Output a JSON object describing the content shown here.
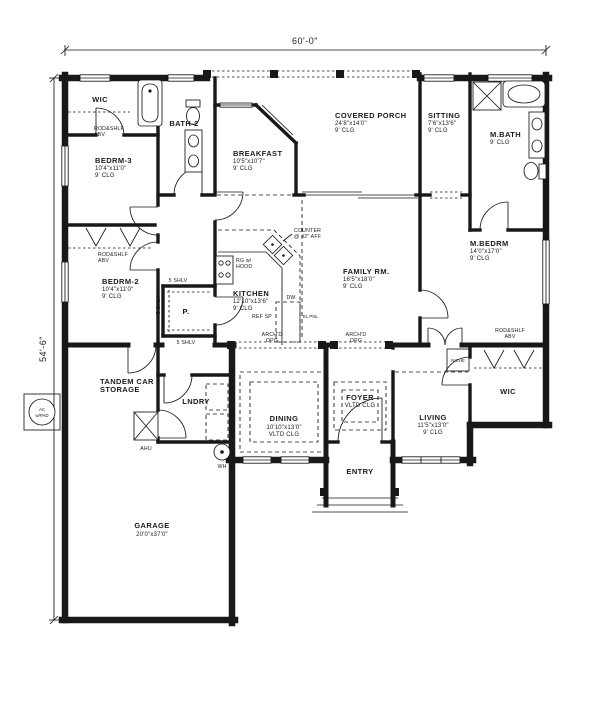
{
  "dimensions": {
    "top": "60'-0\"",
    "left": "54'-6\""
  },
  "rooms": {
    "wic1": {
      "name": "WIC"
    },
    "bedrm3": {
      "name": "BEDRM-3",
      "size": "10'4\"x11'0\"",
      "clg": "9' CLG"
    },
    "bath2": {
      "name": "BATH-2"
    },
    "bedrm2": {
      "name": "BEDRM-2",
      "size": "10'4\"x11'0\"",
      "clg": "9' CLG"
    },
    "breakfast": {
      "name": "BREAKFAST",
      "size": "10'5\"x10'7\"",
      "clg": "9' CLG"
    },
    "porch": {
      "name": "COVERED PORCH",
      "size": "24'8\"x14'0\"",
      "clg": "9' CLG"
    },
    "sitting": {
      "name": "SITTING",
      "size": "7'6\"x13'6\"",
      "clg": "9' CLG"
    },
    "mbath": {
      "name": "M.BATH",
      "clg": "9' CLG"
    },
    "mbedrm": {
      "name": "M.BEDRM",
      "size": "14'0\"x17'0\"",
      "clg": "9' CLG"
    },
    "family": {
      "name": "FAMILY RM.",
      "size": "16'5\"x18'0\"",
      "clg": "9' CLG"
    },
    "kitchen": {
      "name": "KITCHEN",
      "size": "12'10\"x13'6\"",
      "clg": "9' CLG"
    },
    "pantry": {
      "name": "P."
    },
    "dining": {
      "name": "DINING",
      "size": "10'10\"x13'0\"",
      "clg": "VLTD CLG"
    },
    "foyer": {
      "name": "FOYER",
      "clg": "VLTD CLG"
    },
    "entry": {
      "name": "ENTRY"
    },
    "living": {
      "name": "LIVING",
      "size": "11'5\"x13'0\"",
      "clg": "9' CLG"
    },
    "wic2": {
      "name": "WIC"
    },
    "tandem": {
      "line1": "TANDEM CAR",
      "line2": "STORAGE"
    },
    "laundry": {
      "name": "LNDRY"
    },
    "garage": {
      "name": "GARAGE",
      "size": "20'0\"x37'0\""
    }
  },
  "annotations": {
    "rod_shelf": "ROD&SHLF",
    "abv": "ABV",
    "arch": "ARCH'D",
    "opg": "OPG",
    "counter1": "COUNTER",
    "counter2": "@ 42\" AFF",
    "range1": "RG w/",
    "range2": "HOOD",
    "dw": "DW",
    "ref": "REF SP",
    "shelves": "5 SHLV",
    "el_pnl": "EL PNL",
    "niche": "NICHE",
    "ac1": "AC",
    "ac2": "w/PAD",
    "ahu": "AHU",
    "wh": "WH"
  }
}
